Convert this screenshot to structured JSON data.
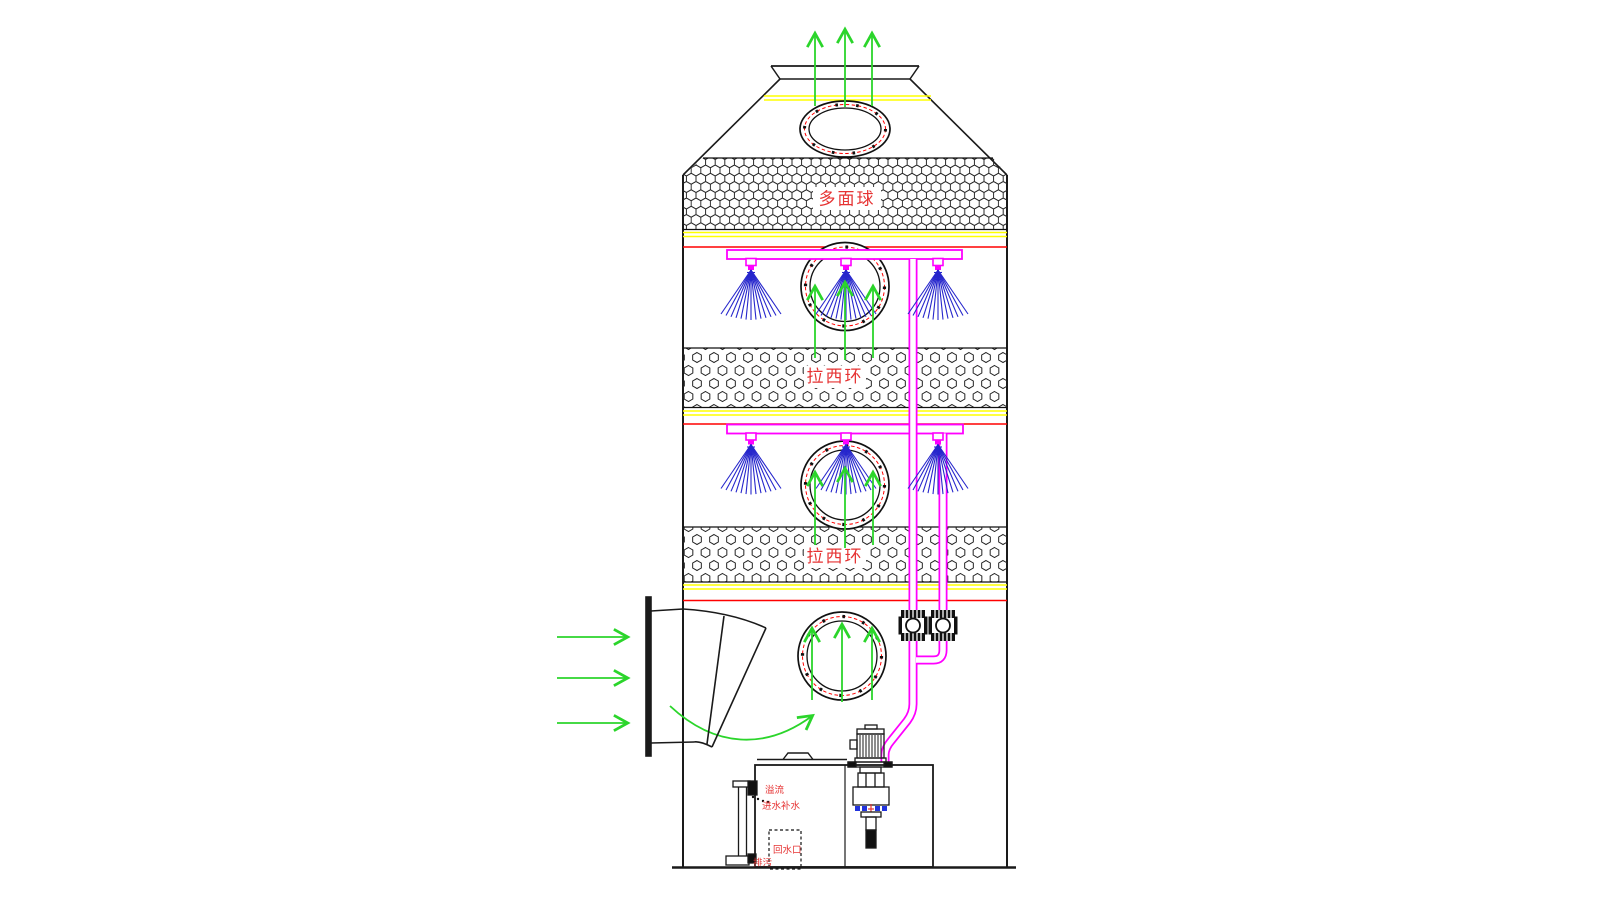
{
  "diagram": {
    "type": "spray-tower-scrubber-schematic",
    "labels": {
      "packing_ball": "多面球",
      "raschig_ring_upper": "拉西环",
      "raschig_ring_lower": "拉西环",
      "overflow": "溢流",
      "water_makeup": "进水补水",
      "return_port": "回水口",
      "drain": "排污"
    },
    "colors": {
      "pipe_magenta": "#ff00ff",
      "spray_blue": "#2626cc",
      "flow_green": "#2bd52b",
      "band_yellow": "#ffff00",
      "band_red": "#ff0000",
      "label_red": "#e63333",
      "line_black": "#1a1a1a"
    }
  }
}
